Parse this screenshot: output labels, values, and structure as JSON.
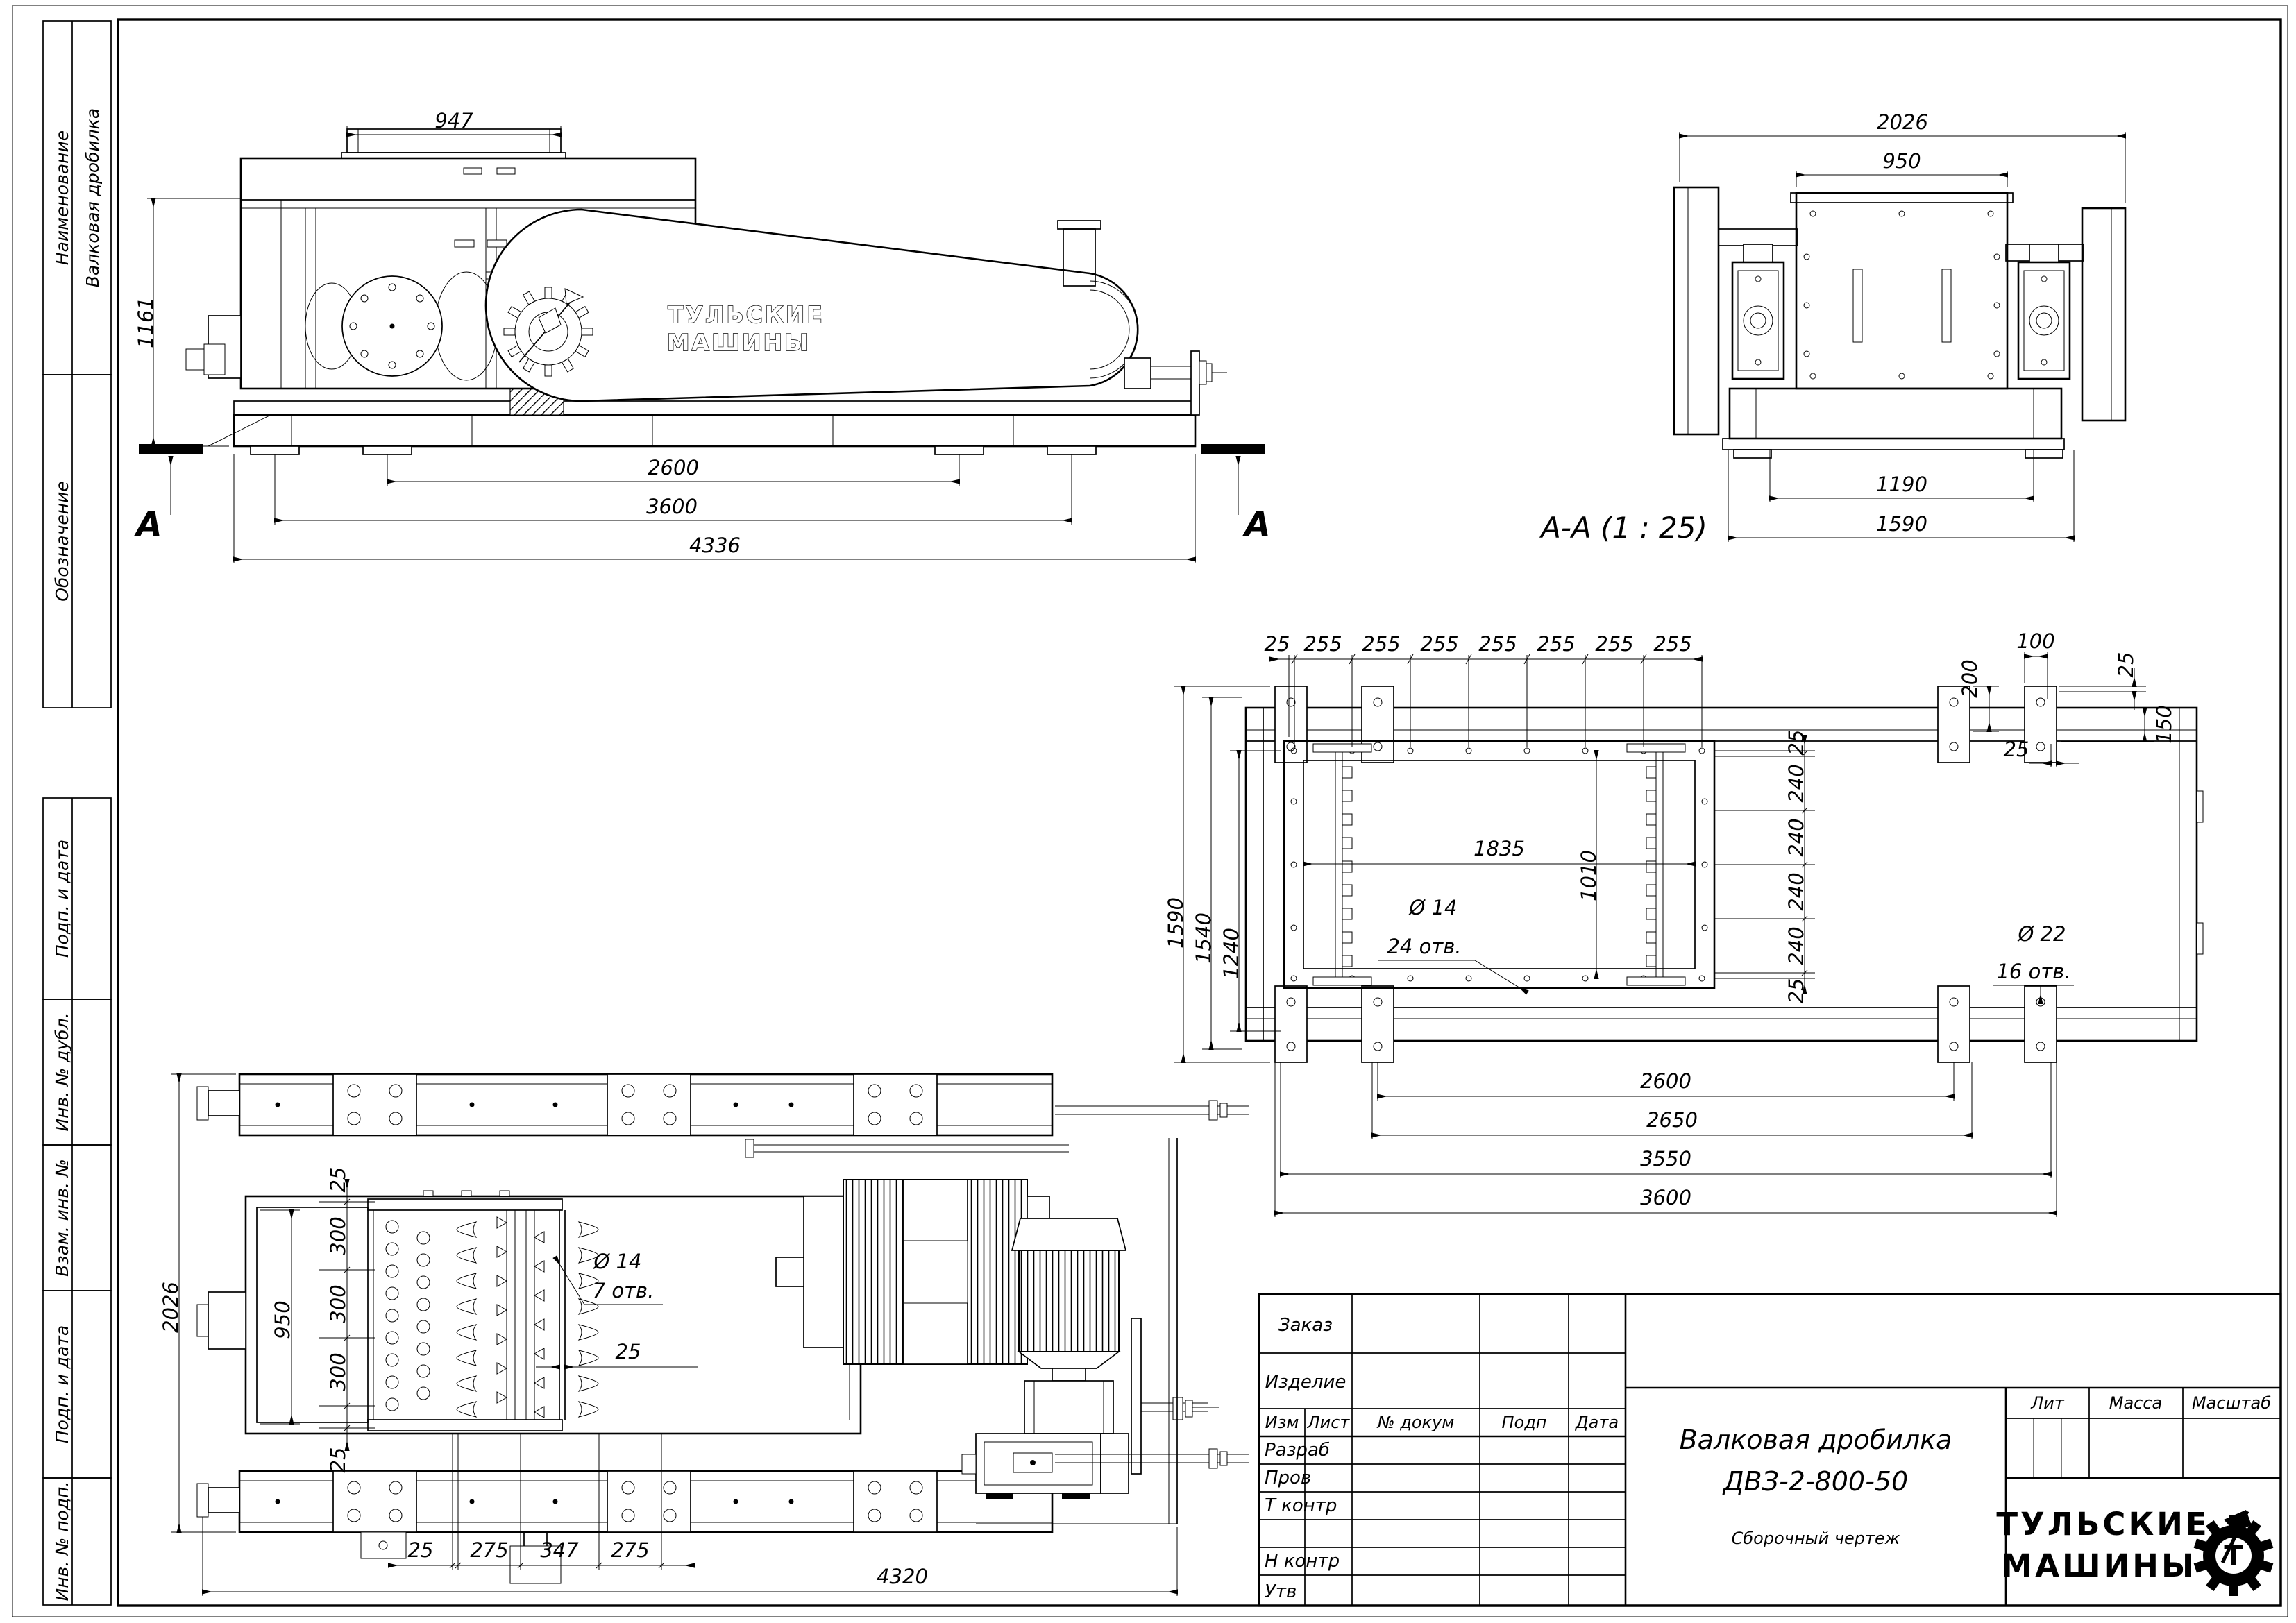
{
  "sheet": {
    "sidebar": {
      "naimenovanie_label": "Наименование",
      "naimenovanie_value": "Валковая дробилка",
      "oboznachenie_label": "Обозначение",
      "podp_data_1": "Подп. и дата",
      "inv_dubl": "Инв. № дубл.",
      "vzam_inv": "Взам. инв. №",
      "podp_data_2": "Подп. и дата",
      "inv_podp": "Инв. № подп."
    }
  },
  "side_view": {
    "dim_947": "947",
    "dim_1161": "1161",
    "dim_2600": "2600",
    "dim_3600": "3600",
    "dim_4336": "4336",
    "section_letter_left": "А",
    "section_letter_right": "А",
    "logo_line1": "ТУЛЬСКИЕ",
    "logo_line2": "МАШИНЫ"
  },
  "section_view": {
    "label": "А-А (1 : 25)",
    "dim_2026": "2026",
    "dim_950": "950",
    "dim_1190": "1190",
    "dim_1590": "1590"
  },
  "frame_plan": {
    "top_chain": [
      "25",
      "255",
      "255",
      "255",
      "255",
      "255",
      "255",
      "255"
    ],
    "right_chain": [
      "25",
      "240",
      "240",
      "240",
      "240",
      "25"
    ],
    "left_dims": [
      "1590",
      "1540",
      "1240"
    ],
    "corner": {
      "d100": "100",
      "d200": "200",
      "d25a": "25",
      "d25b": "25",
      "d150": "150"
    },
    "inner": {
      "d1835": "1835",
      "d1010": "1010"
    },
    "holes14": {
      "dia": "Ø 14",
      "count": "24 отв."
    },
    "holes22": {
      "dia": "Ø 22",
      "count": "16 отв."
    },
    "bottom_dims": [
      "2600",
      "2650",
      "3550",
      "3600"
    ]
  },
  "top_view": {
    "dim_2026": "2026",
    "dim_950": "950",
    "chain": [
      "25",
      "300",
      "300",
      "300",
      "25"
    ],
    "holes14": {
      "dia": "Ø 14",
      "count": "7 отв."
    },
    "dim_25": "25",
    "bottom_chain": [
      "25",
      "275",
      "347",
      "275"
    ],
    "dim_4320": "4320"
  },
  "title_block": {
    "zakaz": "Заказ",
    "izdelie": "Изделие",
    "header": [
      "Изм",
      "Лист",
      "№ докум",
      "Подп",
      "Дата"
    ],
    "rows": [
      "Разраб",
      "Пров",
      "Т контр",
      "Н контр",
      "Утв"
    ],
    "title1": "Валковая дробилка",
    "title2": "ДВЗ-2-800-50",
    "subtitle": "Сборочный чертеж",
    "lit": "Лит",
    "massa": "Масса",
    "masshtab": "Масштаб",
    "logo1": "ТУЛЬСКИЕ",
    "logo2": "МАШИНЫ",
    "logo_t": "Т"
  }
}
